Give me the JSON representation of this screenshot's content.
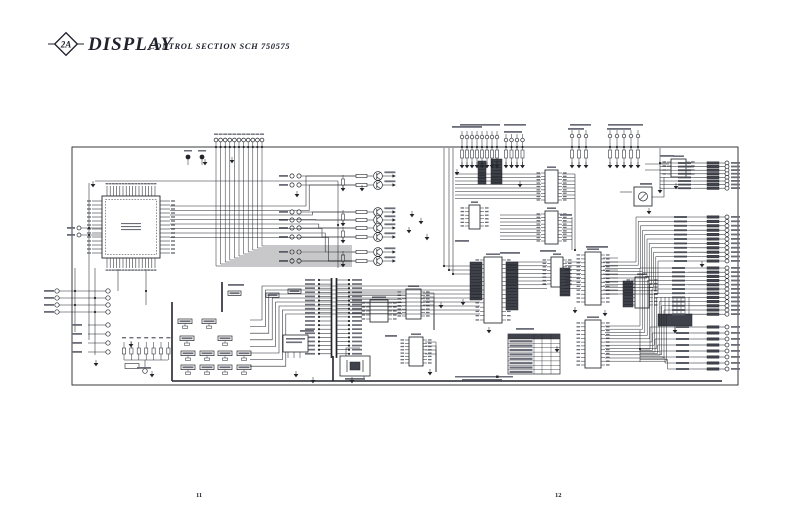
{
  "title": {
    "badge": "2A",
    "main": "DISPLAY",
    "sub": "CONTROL SECTION SCH 750575"
  },
  "footer": {
    "page_left": "11",
    "page_right": "12"
  },
  "colors": {
    "ink": "#23252b",
    "paper": "#ffffff",
    "bar": "#6b6e78",
    "dark": "#3f424a"
  },
  "schematic": {
    "frame": {
      "x": 72,
      "y": 147,
      "w": 666,
      "h": 238
    },
    "heavies": [
      [
        172,
        381,
        722,
        381
      ],
      [
        172,
        302,
        172,
        381
      ],
      [
        333,
        356,
        333,
        381
      ],
      [
        222,
        282,
        222,
        312
      ]
    ],
    "qfp": {
      "x": 102,
      "y": 196,
      "w": 58,
      "h": 62,
      "top": 16,
      "side": 14,
      "stub": 10
    },
    "dips": [
      [
        545,
        170,
        13,
        33,
        9
      ],
      [
        545,
        211,
        13,
        33,
        9
      ],
      [
        469,
        205,
        11,
        24,
        6
      ],
      [
        484,
        257,
        18,
        66,
        15
      ],
      [
        551,
        257,
        12,
        30,
        8
      ],
      [
        585,
        252,
        16,
        53,
        13
      ],
      [
        585,
        320,
        16,
        48,
        12
      ],
      [
        635,
        277,
        14,
        31,
        8
      ],
      [
        671,
        159,
        15,
        18,
        4
      ],
      [
        406,
        289,
        15,
        30,
        8
      ],
      [
        409,
        337,
        14,
        29,
        8
      ],
      [
        370,
        300,
        18,
        22,
        5
      ]
    ],
    "trimmer": [
      634,
      187,
      18,
      19
    ],
    "resnets": [
      [
        470,
        262,
        12,
        38
      ],
      [
        506,
        262,
        12,
        48
      ],
      [
        560,
        268,
        10,
        28
      ],
      [
        623,
        281,
        10,
        26
      ],
      [
        478,
        161,
        8,
        23
      ],
      [
        491,
        159,
        11,
        25
      ]
    ],
    "resnet_h": [
      658,
      314,
      34,
      12
    ],
    "transistors": {
      "x": 378,
      "ys": [
        176,
        185,
        212,
        220,
        228,
        237,
        252,
        261
      ]
    },
    "pair_res": [
      [
        343,
        181
      ],
      [
        343,
        216
      ],
      [
        343,
        233
      ],
      [
        343,
        257
      ]
    ],
    "top_circles": {
      "y": 140,
      "x0": 216,
      "n": 11,
      "pitch": 4.6
    },
    "pullups": [
      {
        "x0": 462,
        "n": 8,
        "pitch": 5.0,
        "cy": 137
      },
      {
        "x0": 506,
        "n": 4,
        "pitch": 5.5,
        "cy": 140
      },
      {
        "x0": 572,
        "n": 3,
        "pitch": 7.0,
        "cy": 136
      },
      {
        "x0": 610,
        "n": 5,
        "pitch": 7.0,
        "cy": 136
      }
    ],
    "pin_groups": [
      {
        "cx": 727,
        "y0": 163,
        "n": 8,
        "pitch": 3.6,
        "lx": 694
      },
      {
        "cx": 727,
        "y0": 217,
        "n": 11,
        "pitch": 4.4,
        "lx": 690
      },
      {
        "cx": 727,
        "y0": 268,
        "n": 12,
        "pitch": 4.2,
        "lx": 688
      },
      {
        "cx": 727,
        "y0": 327,
        "n": 8,
        "pitch": 6.0,
        "lx": 692
      }
    ],
    "ribbon": {
      "x": 334,
      "y0": 280,
      "n": 19,
      "pitch": 4.1
    },
    "left_conn_a": {
      "x1": 57,
      "x2": 108,
      "ys": [
        291,
        298,
        305,
        312
      ]
    },
    "left_conn_b": {
      "x1": 88,
      "x2": 108,
      "ys": [
        325,
        334,
        343,
        352
      ]
    },
    "diode_row": {
      "x0": 124,
      "n": 7,
      "pitch": 7.4,
      "ytop": 342,
      "ybot": 360
    },
    "label_grid": [
      {
        "y": 319,
        "xs": [
          178,
          202
        ]
      },
      {
        "y": 336,
        "xs": [
          180,
          218
        ]
      },
      {
        "y": 351,
        "xs": [
          181,
          200,
          218,
          237
        ]
      },
      {
        "y": 365,
        "xs": [
          181,
          200,
          218,
          237
        ]
      }
    ],
    "top_boxes": [
      [
        228,
        291
      ],
      [
        266,
        293
      ],
      [
        288,
        289
      ]
    ],
    "clockgen": [
      283,
      335,
      25,
      17
    ],
    "crystal": [
      340,
      356,
      30,
      20
    ],
    "table": {
      "x": 508,
      "y": 334,
      "w": 52,
      "h": 40,
      "rows": 8,
      "cols": [
        26,
        8,
        9,
        9
      ]
    },
    "note": {
      "bars": [
        [
          455,
          376,
          58
        ],
        [
          462,
          379,
          40
        ]
      ],
      "square": [
        496,
        375.5
      ]
    },
    "testpoints": [
      [
        188,
        157
      ],
      [
        202,
        157
      ]
    ],
    "left_pads2": [
      [
        79,
        228
      ],
      [
        79,
        235
      ]
    ],
    "grounds": [
      [
        93,
        184
      ],
      [
        297,
        194
      ],
      [
        362,
        188
      ],
      [
        412,
        214
      ],
      [
        421,
        221
      ],
      [
        409,
        230
      ],
      [
        427,
        237
      ],
      [
        457,
        172
      ],
      [
        520,
        184
      ],
      [
        463,
        302
      ],
      [
        441,
        305
      ],
      [
        489,
        330
      ],
      [
        557,
        349
      ],
      [
        575,
        310
      ],
      [
        605,
        313
      ],
      [
        649,
        211
      ],
      [
        676,
        186
      ],
      [
        702,
        264
      ],
      [
        296,
        374
      ],
      [
        313,
        380
      ],
      [
        352,
        380
      ],
      [
        430,
        372
      ],
      [
        131,
        344
      ],
      [
        96,
        363
      ],
      [
        152,
        374
      ],
      [
        205,
        162
      ],
      [
        232,
        160
      ],
      [
        660,
        190
      ]
    ],
    "dots": [
      [
        75,
        291
      ],
      [
        95,
        298
      ],
      [
        75,
        305
      ],
      [
        95,
        312
      ],
      [
        89,
        228
      ],
      [
        89,
        235
      ],
      [
        338,
        225
      ],
      [
        444,
        266
      ],
      [
        449,
        270
      ],
      [
        453,
        274
      ],
      [
        575,
        250
      ],
      [
        640,
        349
      ],
      [
        660,
        163
      ],
      [
        146,
        291
      ]
    ],
    "bars": [
      [
        452,
        126,
        30
      ],
      [
        504,
        131,
        18
      ],
      [
        568,
        128,
        16
      ],
      [
        607,
        128,
        24
      ],
      [
        137,
        367,
        14
      ],
      [
        228,
        284,
        16
      ],
      [
        300,
        330,
        14
      ],
      [
        385,
        335,
        12
      ],
      [
        500,
        252,
        20
      ],
      [
        540,
        250,
        16
      ],
      [
        586,
        246,
        22
      ],
      [
        660,
        155,
        14
      ],
      [
        640,
        183,
        12
      ],
      [
        516,
        328,
        18
      ],
      [
        455,
        240,
        14
      ],
      [
        560,
        214,
        12
      ]
    ],
    "wires": [
      [
        89,
        183,
        89,
        340
      ],
      [
        95,
        181,
        338,
        181
      ],
      [
        338,
        181,
        338,
        268
      ],
      [
        81,
        228,
        102,
        228
      ],
      [
        81,
        235,
        102,
        235
      ],
      [
        75,
        268,
        75,
        332
      ],
      [
        95,
        268,
        95,
        355
      ],
      [
        118,
        269,
        118,
        291
      ],
      [
        146,
        269,
        146,
        305
      ],
      [
        444,
        148,
        444,
        266,
        482,
        266
      ],
      [
        449,
        148,
        449,
        270,
        482,
        270
      ],
      [
        453,
        148,
        453,
        274,
        482,
        274
      ],
      [
        660,
        148,
        660,
        188
      ],
      [
        575,
        174,
        575,
        250
      ],
      [
        572,
        217,
        572,
        250
      ],
      [
        620,
        192,
        632,
        192
      ],
      [
        652,
        197,
        664,
        197,
        664,
        177
      ],
      [
        645,
        164,
        669,
        164
      ],
      [
        645,
        170,
        669,
        170
      ],
      [
        688,
        167,
        694,
        167
      ],
      [
        640,
        330,
        640,
        362
      ],
      [
        346,
        356,
        346,
        348,
        360,
        348
      ],
      [
        364,
        376,
        364,
        380
      ],
      [
        124,
        360,
        168,
        360
      ],
      [
        145,
        360,
        145,
        368
      ]
    ]
  }
}
